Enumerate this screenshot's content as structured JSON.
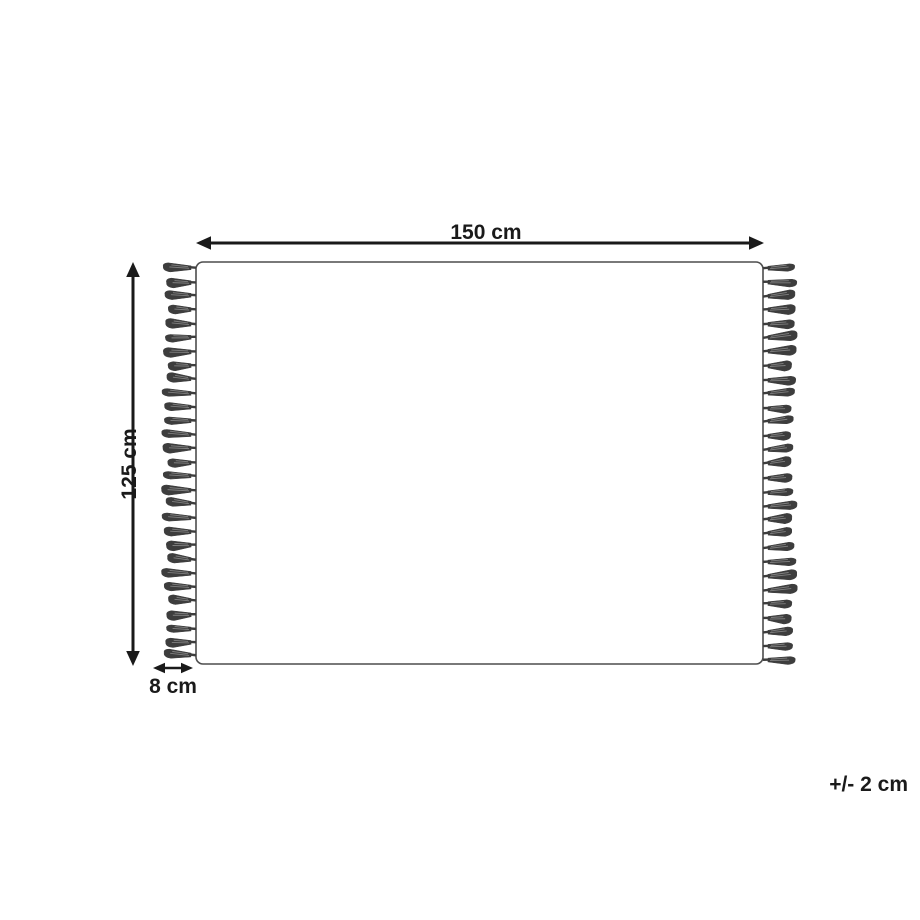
{
  "diagram": {
    "type": "product-dimension-diagram",
    "width_label": "150 cm",
    "height_label": "125 cm",
    "fringe_label": "8 cm",
    "tolerance_label": "+/- 2 cm",
    "fringe": {
      "tassels_per_side": 29,
      "sides": [
        "left",
        "right"
      ]
    },
    "colors": {
      "ink": "#1a1a1a",
      "outline": "#4d4d4d",
      "tassel": "#3d3d3d",
      "tassel_highlight": "#8c8c8c",
      "background": "#ffffff"
    }
  }
}
